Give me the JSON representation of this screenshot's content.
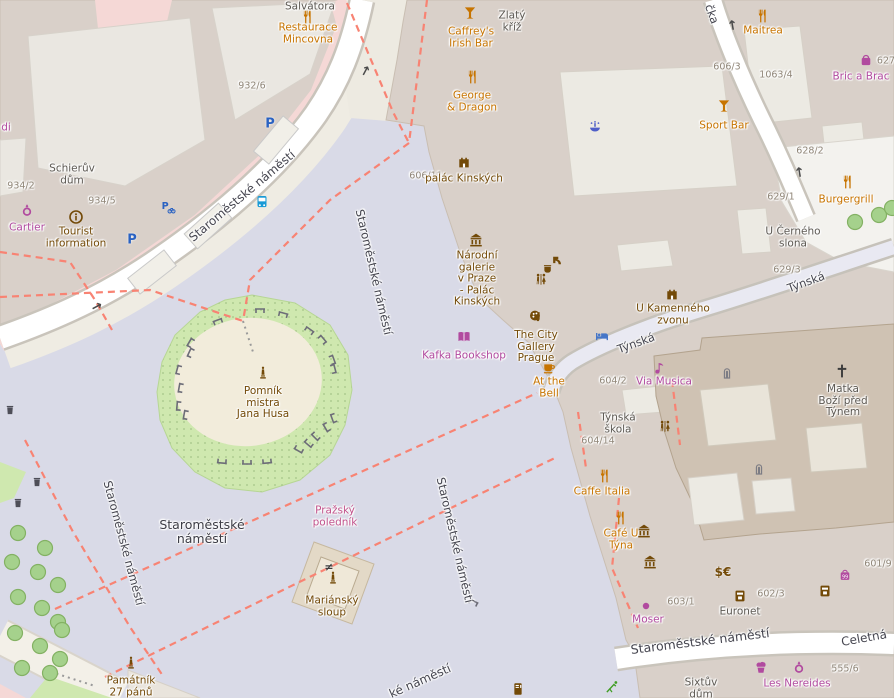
{
  "map_title": "Staroměstské náměstí, Prague — OpenStreetMap view",
  "colors": {
    "food": "#c77400",
    "shop": "#b14a9f",
    "brown": "#734a08",
    "dark": "#5c5852",
    "pink": "#c2538c",
    "street": "#45454f",
    "housenum": "#8f8577",
    "place": "#3c3c45",
    "blue_bed": "#4576c8",
    "blue_bus": "#189ad6",
    "blue_fountain": "#4f5fc8",
    "blue_parking": "#2a62c2",
    "green_leisure": "#3f9d23",
    "grey_feature": "#7c7c84",
    "path_red": "#f88373",
    "square_fill": "#d9dae7",
    "building_fill": "#d9d0c9",
    "church_fill": "#cfc2b3",
    "retail_pink": "#f5d8d6",
    "grass": "#cfe8af"
  },
  "place_labels": [
    {
      "lines": [
        "Staroměstské",
        "náměstí"
      ],
      "x": 202,
      "y": 532
    }
  ],
  "street_labels": [
    {
      "text": "Staroměstské náměstí",
      "x": 242,
      "y": 196,
      "rot": -40,
      "size": 12
    },
    {
      "text": "Staroměstské náměstí",
      "x": 374,
      "y": 272,
      "rot": 77,
      "size": 11.5
    },
    {
      "text": "Staroměstské náměstí",
      "x": 455,
      "y": 540,
      "rot": 77,
      "size": 11.5
    },
    {
      "text": "Staroměstské náměstí",
      "x": 124,
      "y": 543,
      "rot": 75,
      "size": 11.5
    },
    {
      "text": "Staroměstské náměstí",
      "x": 700,
      "y": 641,
      "rot": -7,
      "size": 12.5
    },
    {
      "text": "ké náměstí",
      "x": 420,
      "y": 681,
      "rot": -24,
      "size": 12
    },
    {
      "text": "Týnská",
      "x": 806,
      "y": 282,
      "rot": -20,
      "size": 11.5
    },
    {
      "text": "Týnská",
      "x": 636,
      "y": 343,
      "rot": -20,
      "size": 11.5
    },
    {
      "text": "čka",
      "x": 712,
      "y": 14,
      "rot": 70,
      "size": 11.5
    },
    {
      "text": "Celetná",
      "x": 864,
      "y": 638,
      "rot": -10,
      "size": 12
    }
  ],
  "house_numbers": [
    {
      "text": "932/6",
      "x": 252,
      "y": 86
    },
    {
      "text": "934/2",
      "x": 21,
      "y": 186
    },
    {
      "text": "934/5",
      "x": 102,
      "y": 201
    },
    {
      "text": "606/11",
      "x": 426,
      "y": 176
    },
    {
      "text": "606/3",
      "x": 727,
      "y": 67
    },
    {
      "text": "1063/4",
      "x": 776,
      "y": 75
    },
    {
      "text": "627",
      "x": 886,
      "y": 61
    },
    {
      "text": "628/2",
      "x": 810,
      "y": 151
    },
    {
      "text": "629/1",
      "x": 781,
      "y": 197
    },
    {
      "text": "629/3",
      "x": 787,
      "y": 270
    },
    {
      "text": "604/2",
      "x": 613,
      "y": 381
    },
    {
      "text": "604/14",
      "x": 598,
      "y": 441
    },
    {
      "text": "603/1",
      "x": 681,
      "y": 602
    },
    {
      "text": "602/3",
      "x": 771,
      "y": 594
    },
    {
      "text": "601/9",
      "x": 878,
      "y": 564
    },
    {
      "text": "555/6",
      "x": 845,
      "y": 669
    }
  ],
  "pois": [
    {
      "id": "restaurace-mincovna",
      "icon": "restaurant",
      "ix": 307,
      "iy": 17,
      "lines": [
        "Restaurace",
        "Mincovna"
      ],
      "lx": 308,
      "ly": 34,
      "cls": "food"
    },
    {
      "id": "caffreys-irish-bar",
      "icon": "bar",
      "ix": 470,
      "iy": 13,
      "lines": [
        "Caffrey's",
        "Irish Bar"
      ],
      "lx": 471,
      "ly": 38,
      "cls": "food"
    },
    {
      "id": "george-and-dragon",
      "icon": "restaurant",
      "ix": 472,
      "iy": 77,
      "lines": [
        "George",
        "& Dragon"
      ],
      "lx": 472,
      "ly": 102,
      "cls": "food"
    },
    {
      "id": "maitrea",
      "icon": "restaurant",
      "ix": 762,
      "iy": 16,
      "lines": [
        "Maitrea"
      ],
      "lx": 763,
      "ly": 31,
      "cls": "food"
    },
    {
      "id": "sport-bar",
      "icon": "bar",
      "ix": 724,
      "iy": 106,
      "lines": [
        "Sport Bar"
      ],
      "lx": 724,
      "ly": 126,
      "cls": "food"
    },
    {
      "id": "burgergrill",
      "icon": "restaurant",
      "ix": 847,
      "iy": 182,
      "lines": [
        "Burgergrill"
      ],
      "lx": 846,
      "ly": 200,
      "cls": "food"
    },
    {
      "id": "bric-a-brac",
      "icon": "gift",
      "ix": 866,
      "iy": 60,
      "lines": [
        "Bric a Brac"
      ],
      "lx": 861,
      "ly": 77,
      "cls": "shop"
    },
    {
      "id": "cartier",
      "icon": "ring",
      "ix": 27,
      "iy": 210,
      "lines": [
        "Cartier"
      ],
      "lx": 27,
      "ly": 228,
      "cls": "shop"
    },
    {
      "id": "tourist-information",
      "icon": "info",
      "ix": 76,
      "iy": 217,
      "lines": [
        "Tourist",
        "information"
      ],
      "lx": 76,
      "ly": 238,
      "cls": "brown"
    },
    {
      "id": "palac-kinskych",
      "icon": "palace",
      "ix": 464,
      "iy": 161,
      "lines": [
        "palác Kinských"
      ],
      "lx": 464,
      "ly": 179,
      "cls": "brown"
    },
    {
      "id": "narodni-galerie",
      "icon": "museum",
      "ix": 476,
      "iy": 240,
      "lines": [
        "Národní",
        "galerie",
        "v Praze",
        "- Palác",
        "Kinských"
      ],
      "lx": 477,
      "ly": 279,
      "cls": "brown"
    },
    {
      "id": "city-gallery-prague",
      "icon": "gallery",
      "ix": 536,
      "iy": 316,
      "lines": [
        "The City",
        "Gallery",
        "Prague"
      ],
      "lx": 536,
      "ly": 347,
      "cls": "brown"
    },
    {
      "id": "kafka-bookshop",
      "icon": "book",
      "ix": 464,
      "iy": 337,
      "lines": [
        "Kafka Bookshop"
      ],
      "lx": 464,
      "ly": 356,
      "cls": "shop"
    },
    {
      "id": "at-the-bell",
      "icon": "cafe",
      "ix": 549,
      "iy": 367,
      "lines": [
        "At the",
        "Bell"
      ],
      "lx": 549,
      "ly": 388,
      "cls": "food"
    },
    {
      "id": "via-musica",
      "icon": "music",
      "ix": 660,
      "iy": 368,
      "lines": [
        "Via Musica"
      ],
      "lx": 664,
      "ly": 382,
      "cls": "shop"
    },
    {
      "id": "u-kamenneho-zvonu",
      "icon": "palace",
      "ix": 672,
      "iy": 293,
      "lines": [
        "U Kamenného",
        "zvonu"
      ],
      "lx": 673,
      "ly": 315,
      "cls": "brown"
    },
    {
      "id": "tynska-skola",
      "icon": null,
      "ix": 0,
      "iy": 0,
      "lines": [
        "Týnská",
        "škola"
      ],
      "lx": 618,
      "ly": 424,
      "cls": "dark"
    },
    {
      "id": "caffe-italia",
      "icon": "restaurant",
      "ix": 604,
      "iy": 476,
      "lines": [
        "Caffe Italia"
      ],
      "lx": 602,
      "ly": 492,
      "cls": "food"
    },
    {
      "id": "cafe-u-tyna",
      "icon": "restaurant",
      "ix": 620,
      "iy": 518,
      "lines": [
        "Café U",
        "Týna"
      ],
      "lx": 621,
      "ly": 540,
      "cls": "food"
    },
    {
      "id": "euronet",
      "icon": "atm",
      "ix": 740,
      "iy": 596,
      "lines": [
        "Euronet"
      ],
      "lx": 740,
      "ly": 612,
      "cls": "dark"
    },
    {
      "id": "moser",
      "icon": "dot",
      "ix": 646,
      "iy": 606,
      "lines": [
        "Moser"
      ],
      "lx": 648,
      "ly": 620,
      "cls": "shop"
    },
    {
      "id": "les-nereides",
      "icon": "cupcake",
      "ix": 761,
      "iy": 667,
      "lines": [
        "Les Nereides"
      ],
      "lx": 797,
      "ly": 684,
      "cls": "shop"
    },
    {
      "id": "pomnik-mistra-jana-husa",
      "icon": "memorial",
      "ix": 263,
      "iy": 373,
      "lines": [
        "Pomník",
        "mistra",
        "Jana Husa"
      ],
      "lx": 263,
      "ly": 403,
      "cls": "brown"
    },
    {
      "id": "mariansky-sloup",
      "icon": "memorial",
      "ix": 333,
      "iy": 578,
      "lines": [
        "Mariánský",
        "sloup"
      ],
      "lx": 332,
      "ly": 607,
      "cls": "brown"
    },
    {
      "id": "pamatnik-27-panu",
      "icon": "memorial",
      "ix": 131,
      "iy": 663,
      "lines": [
        "Památník",
        "27 pánů"
      ],
      "lx": 131,
      "ly": 687,
      "cls": "brown"
    },
    {
      "id": "prazsky-polednik",
      "icon": null,
      "ix": 0,
      "iy": 0,
      "lines": [
        "Pražský",
        "poledník"
      ],
      "lx": 335,
      "ly": 517,
      "cls": "pink"
    },
    {
      "id": "matka-bozi-pred-tynem",
      "icon": "cross",
      "ix": 842,
      "iy": 371,
      "lines": [
        "Matka",
        "Boží před",
        "Týnem"
      ],
      "lx": 843,
      "ly": 401,
      "cls": "dark"
    },
    {
      "id": "zlaty-kriz",
      "icon": null,
      "ix": 0,
      "iy": 0,
      "lines": [
        "Zlatý",
        "kříž"
      ],
      "lx": 512,
      "ly": 22,
      "cls": "dark"
    },
    {
      "id": "schieruv-dum",
      "icon": null,
      "ix": 0,
      "iy": 0,
      "lines": [
        "Schierův",
        "dům"
      ],
      "lx": 72,
      "ly": 175,
      "cls": "dark"
    },
    {
      "id": "salvatora",
      "icon": null,
      "ix": 0,
      "iy": 0,
      "lines": [
        "Salvátora"
      ],
      "lx": 310,
      "ly": 7,
      "cls": "dark"
    },
    {
      "id": "u-cerneho-slona",
      "icon": null,
      "ix": 0,
      "iy": 0,
      "lines": [
        "U Černého",
        "slona"
      ],
      "lx": 793,
      "ly": 238,
      "cls": "dark"
    },
    {
      "id": "sixtuv-dum",
      "icon": null,
      "ix": 0,
      "iy": 0,
      "lines": [
        "Sixtův",
        "dům"
      ],
      "lx": 701,
      "ly": 689,
      "cls": "dark"
    },
    {
      "id": "shop-label-partial-di",
      "icon": null,
      "ix": 0,
      "iy": 0,
      "lines": [
        "di"
      ],
      "lx": 6,
      "ly": 128,
      "cls": "shop"
    }
  ],
  "standalone_icons": [
    {
      "type": "toilets",
      "x": 541,
      "y": 280
    },
    {
      "type": "toilets",
      "x": 665,
      "y": 427
    },
    {
      "type": "bed",
      "x": 602,
      "y": 336
    },
    {
      "type": "bus",
      "x": 262,
      "y": 202
    },
    {
      "type": "fountain",
      "x": 595,
      "y": 127
    },
    {
      "type": "parking",
      "x": 132,
      "y": 240
    },
    {
      "type": "parking",
      "x": 270,
      "y": 124
    },
    {
      "type": "parking_bike",
      "x": 168,
      "y": 207
    },
    {
      "type": "drinking_water",
      "x": 557,
      "y": 261
    },
    {
      "type": "cup",
      "x": 548,
      "y": 269
    },
    {
      "type": "church_door",
      "x": 727,
      "y": 372
    },
    {
      "type": "church_door",
      "x": 759,
      "y": 468
    },
    {
      "type": "museum",
      "x": 644,
      "y": 531
    },
    {
      "type": "museum",
      "x": 650,
      "y": 562
    },
    {
      "type": "currency",
      "x": 723,
      "y": 572
    },
    {
      "type": "atm",
      "x": 825,
      "y": 591
    },
    {
      "type": "variety_store",
      "x": 845,
      "y": 575
    },
    {
      "type": "vending",
      "x": 518,
      "y": 689
    },
    {
      "type": "playground",
      "x": 612,
      "y": 687
    },
    {
      "type": "ring",
      "x": 799,
      "y": 667
    },
    {
      "type": "meridian",
      "x": 329,
      "y": 567
    },
    {
      "type": "waste_basket",
      "x": 37,
      "y": 482
    },
    {
      "type": "waste_basket",
      "x": 18,
      "y": 503
    },
    {
      "type": "waste_basket",
      "x": 10,
      "y": 410
    }
  ],
  "oneway_arrows": [
    {
      "x": 366,
      "y": 71,
      "rot": -62
    },
    {
      "x": 97,
      "y": 307,
      "rot": -28
    },
    {
      "x": 733,
      "y": 25,
      "rot": -100
    },
    {
      "x": 800,
      "y": 172,
      "rot": -100
    }
  ],
  "footpaths_red_dashed": [
    [
      [
        347,
        3
      ],
      [
        393,
        112
      ],
      [
        409,
        143
      ]
    ],
    [
      [
        427,
        0
      ],
      [
        409,
        143
      ]
    ],
    [
      [
        409,
        143
      ],
      [
        330,
        200
      ],
      [
        250,
        280
      ],
      [
        243,
        321
      ]
    ],
    [
      [
        0,
        252
      ],
      [
        70,
        262
      ],
      [
        95,
        300
      ],
      [
        112,
        330
      ]
    ],
    [
      [
        0,
        297
      ],
      [
        150,
        290
      ],
      [
        243,
        321
      ]
    ],
    [
      [
        25,
        440
      ],
      [
        72,
        530
      ],
      [
        130,
        627
      ],
      [
        163,
        676
      ]
    ],
    [
      [
        55,
        609
      ],
      [
        247,
        523
      ],
      [
        439,
        437
      ],
      [
        537,
        393
      ]
    ],
    [
      [
        105,
        677
      ],
      [
        281,
        591
      ],
      [
        457,
        505
      ],
      [
        557,
        457
      ]
    ],
    [
      [
        619,
        498
      ],
      [
        612,
        568
      ],
      [
        638,
        628
      ]
    ],
    [
      [
        578,
        412
      ],
      [
        586,
        468
      ]
    ],
    [
      [
        672,
        380
      ],
      [
        680,
        445
      ]
    ]
  ],
  "footpaths_grey_dotted": [
    [
      [
        243,
        321
      ],
      [
        253,
        352
      ]
    ],
    [
      [
        45,
        670
      ],
      [
        95,
        686
      ]
    ]
  ],
  "benches": [
    [
      218,
      322,
      -20
    ],
    [
      260,
      311,
      0
    ],
    [
      283,
      315,
      15
    ],
    [
      309,
      331,
      35
    ],
    [
      322,
      340,
      50
    ],
    [
      332,
      360,
      70
    ],
    [
      333,
      369,
      75
    ],
    [
      191,
      343,
      -60
    ],
    [
      191,
      353,
      -65
    ],
    [
      179,
      370,
      -75
    ],
    [
      181,
      388,
      -80
    ],
    [
      179,
      406,
      -85
    ],
    [
      186,
      415,
      -80
    ],
    [
      334,
      418,
      -110
    ],
    [
      327,
      427,
      -120
    ],
    [
      316,
      436,
      -135
    ],
    [
      309,
      443,
      -140
    ],
    [
      299,
      449,
      -150
    ],
    [
      222,
      461,
      -175
    ],
    [
      247,
      462,
      180
    ],
    [
      267,
      461,
      175
    ],
    [
      473,
      603,
      25
    ]
  ],
  "trees": [
    [
      18,
      533
    ],
    [
      45,
      548
    ],
    [
      12,
      562
    ],
    [
      38,
      572
    ],
    [
      58,
      585
    ],
    [
      18,
      597
    ],
    [
      42,
      608
    ],
    [
      58,
      622
    ],
    [
      15,
      633
    ],
    [
      40,
      646
    ],
    [
      60,
      659
    ],
    [
      22,
      668
    ],
    [
      50,
      673
    ],
    [
      62,
      630
    ],
    [
      855,
      222
    ],
    [
      879,
      215
    ],
    [
      892,
      208
    ]
  ]
}
